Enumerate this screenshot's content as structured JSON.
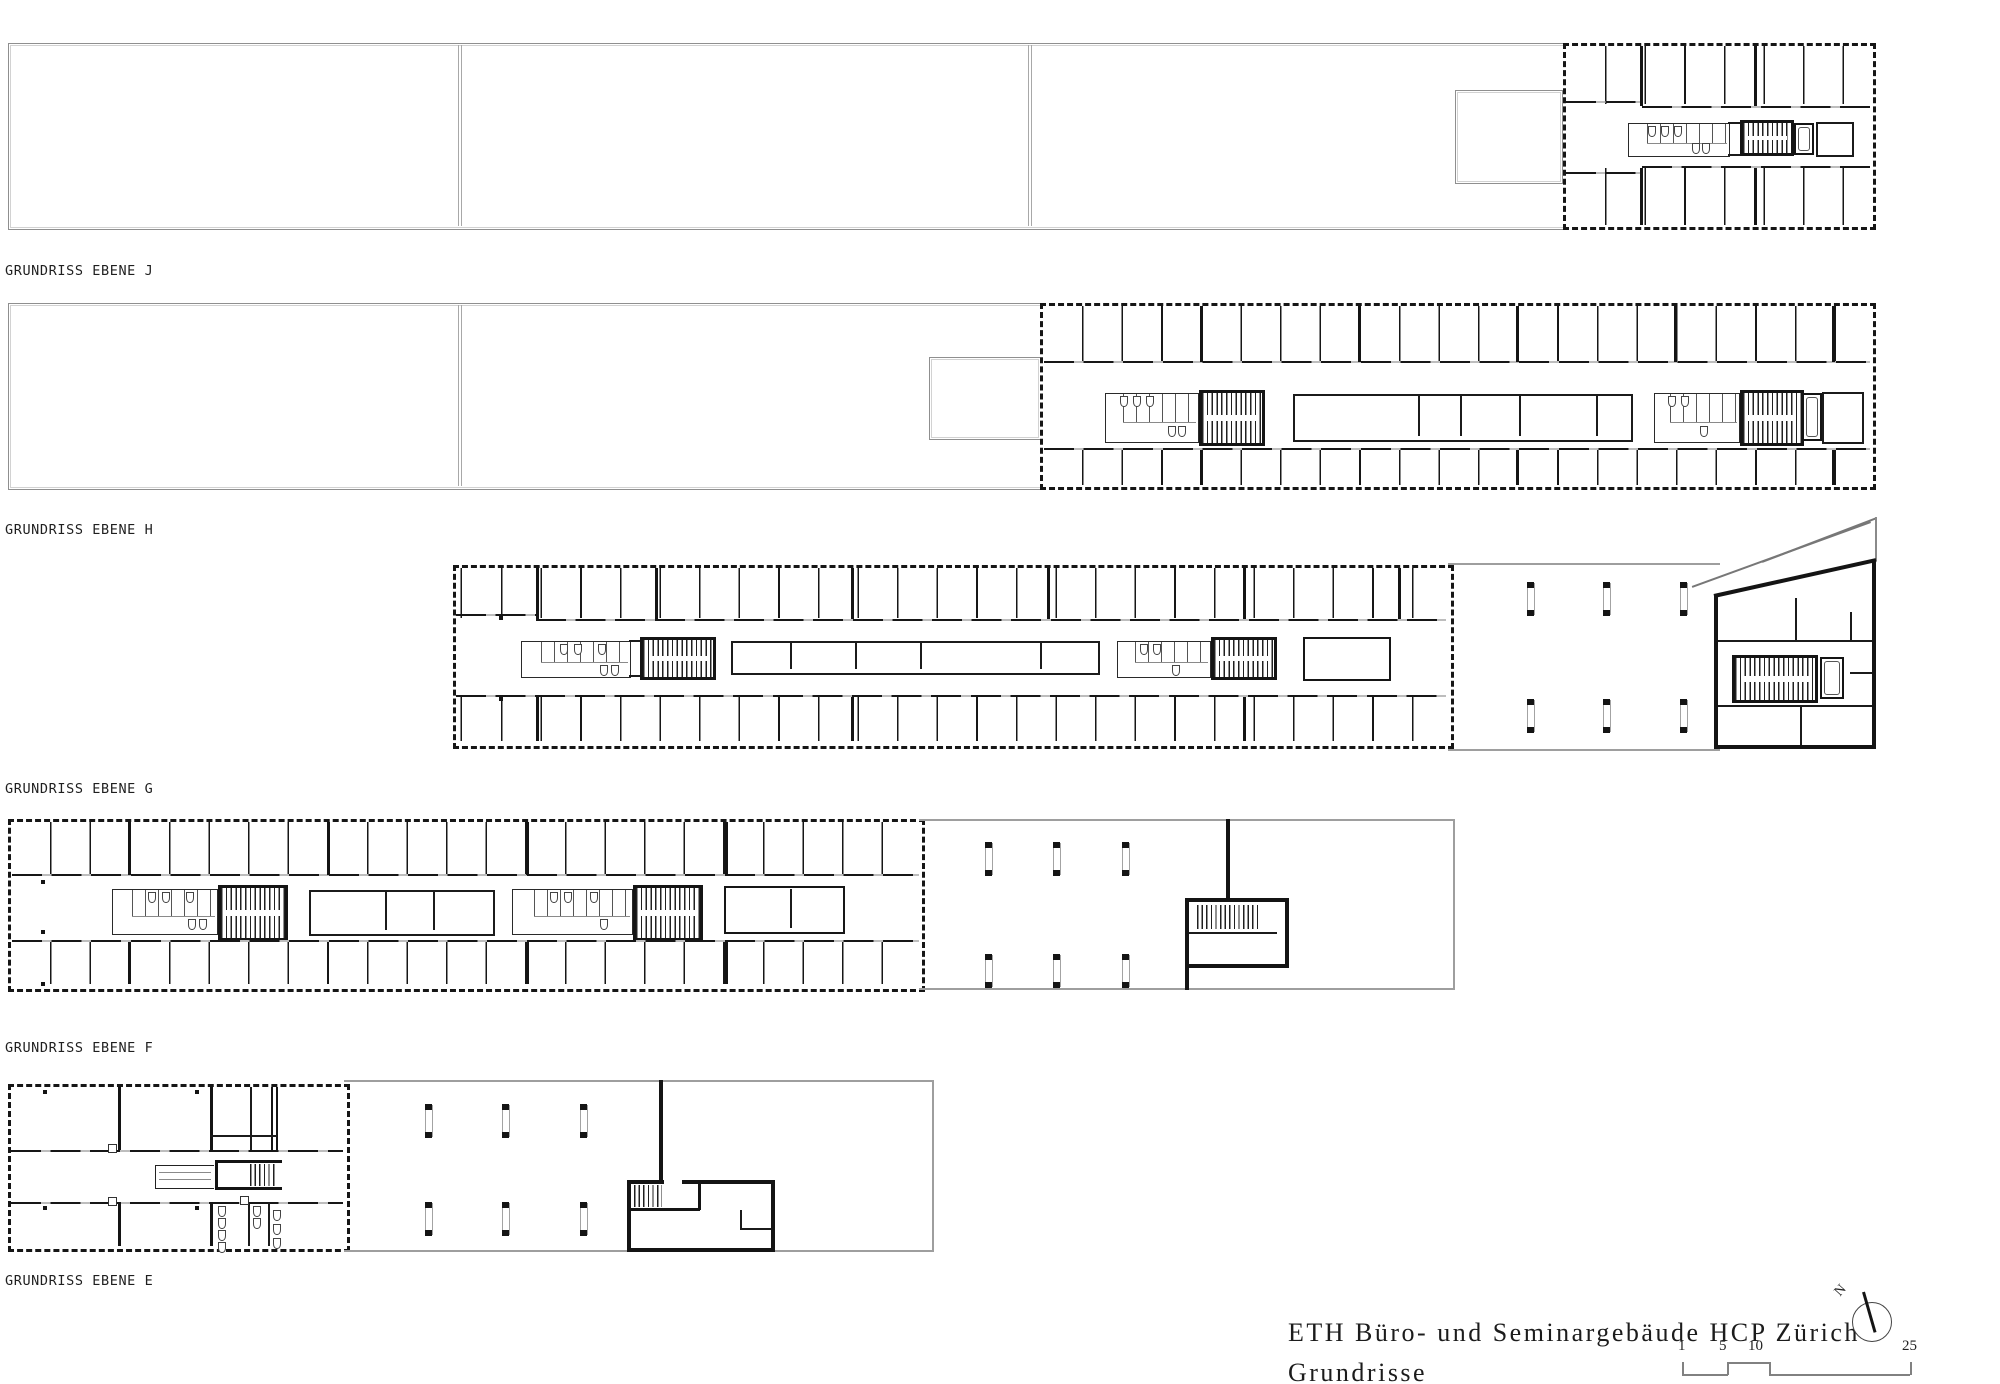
{
  "document": {
    "kind": "architectural floor plan sheet"
  },
  "plans": [
    {
      "id": "J",
      "label": "GRUNDRISS EBENE J"
    },
    {
      "id": "H",
      "label": "GRUNDRISS EBENE H"
    },
    {
      "id": "G",
      "label": "GRUNDRISS EBENE G"
    },
    {
      "id": "F",
      "label": "GRUNDRISS EBENE F"
    },
    {
      "id": "E",
      "label": "GRUNDRISS EBENE E"
    }
  ],
  "title_block": {
    "project": "ETH Büro- und Seminargebäude HCP Zürich",
    "sheet": "Grundrisse"
  },
  "scale_bar": {
    "labels": [
      "1",
      "5",
      "10",
      "25"
    ]
  },
  "north_arrow": {
    "label": "N"
  },
  "colors": {
    "line": "#161616",
    "light_line": "#9e9e9e",
    "door_gap": "#bdbdbd",
    "background": "#ffffff"
  }
}
